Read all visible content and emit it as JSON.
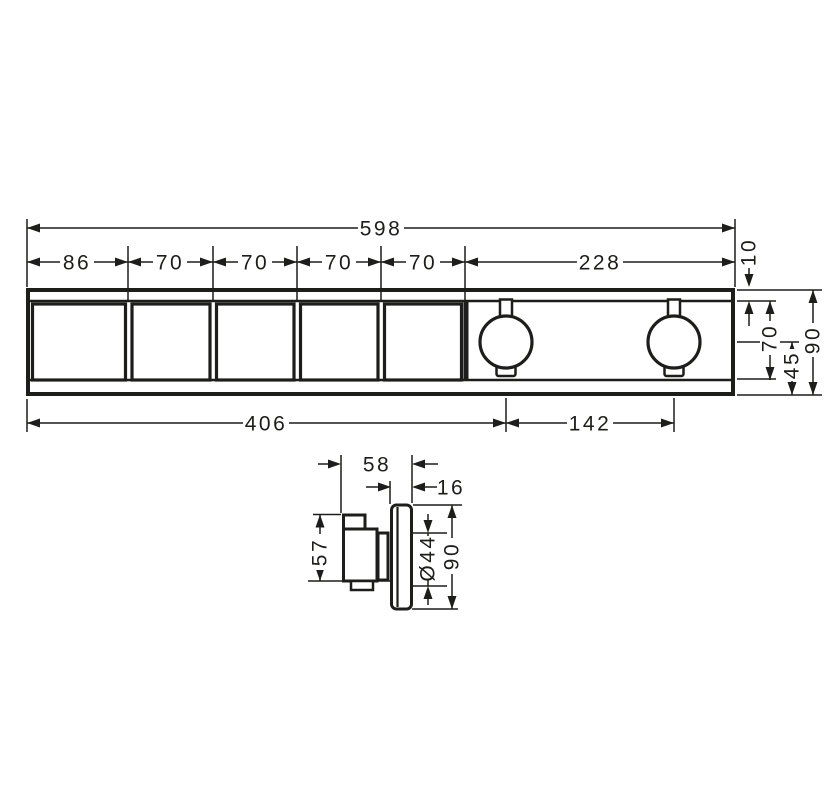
{
  "colors": {
    "line": "#1d1d1b",
    "background": "#ffffff"
  },
  "front_view": {
    "total_width": "598",
    "segment_widths": [
      "86",
      "70",
      "70",
      "70",
      "70",
      "228"
    ],
    "rim_height": "10",
    "inner_height": "70",
    "handle_center_to_bottom": "45",
    "total_height": "90",
    "left_edge_to_handle1_center": "406",
    "handle_center_spacing": "142"
  },
  "side_view": {
    "total_depth": "58",
    "escutcheon_depth": "16",
    "handle_height": "57",
    "escutcheon_diameter": "Ø44",
    "escutcheon_height": "90"
  }
}
